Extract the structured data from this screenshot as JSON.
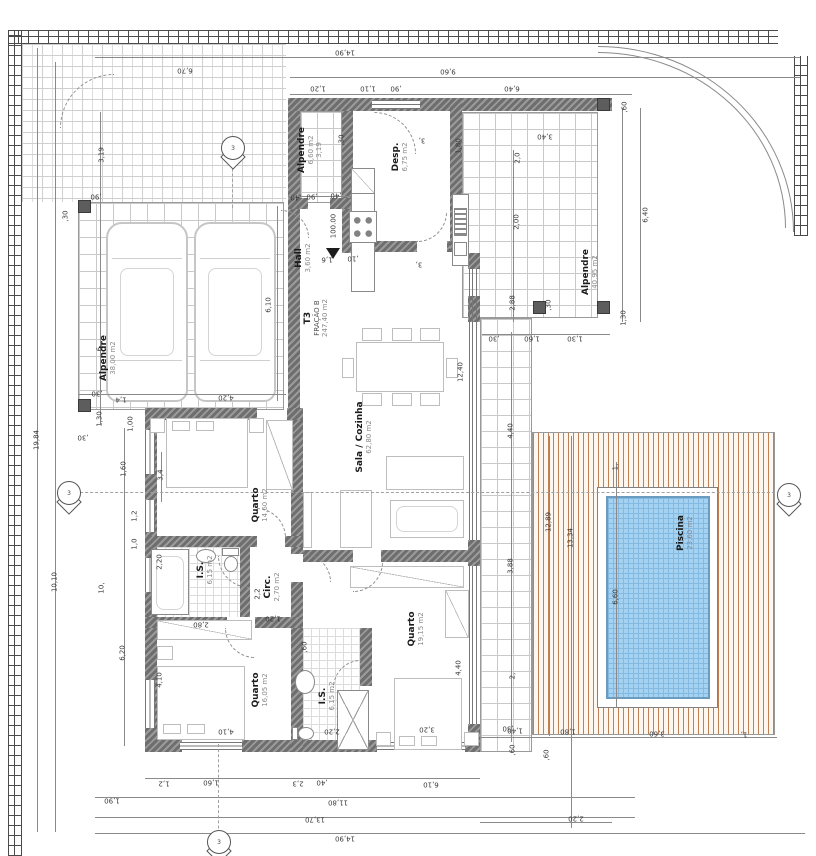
{
  "drawing": {
    "level_marker": "100.00",
    "section_marker_number": "3"
  },
  "rooms": [
    {
      "id": "garage",
      "name": "Alpendre",
      "area": "38,00 m2"
    },
    {
      "id": "porch",
      "name": "Alpendre",
      "area": "6,60 m2",
      "note": "3,19"
    },
    {
      "id": "desp",
      "name": "Desp.",
      "area": "6,75 m2"
    },
    {
      "id": "hall",
      "name": "Hall",
      "area": "3,60 m2"
    },
    {
      "id": "fracao",
      "name": "T3",
      "sub": "FRAÇÃO B",
      "area": "247,40 m2"
    },
    {
      "id": "sala",
      "name": "Sala / Cozinha",
      "area": "62,80 m2"
    },
    {
      "id": "q1",
      "name": "Quarto",
      "area": "14,60 m2"
    },
    {
      "id": "is1",
      "name": "I.S.",
      "area": "6,15 m2"
    },
    {
      "id": "circ",
      "name": "Circ.",
      "area": "2,70 m2"
    },
    {
      "id": "q2",
      "name": "Quarto",
      "area": "16,05 m2"
    },
    {
      "id": "is2",
      "name": "I.S.",
      "area": "6,15 m2"
    },
    {
      "id": "q3",
      "name": "Quarto",
      "area": "19,15 m2"
    },
    {
      "id": "terrace",
      "name": "Alpendre",
      "area": "40,95 m2"
    },
    {
      "id": "piscina",
      "name": "Piscina",
      "area": "23,60 m2"
    }
  ],
  "dim_labels": [
    "14,90",
    "9,60",
    "1,20",
    "1,10",
    ",90",
    "6,40",
    "6,70",
    ",90",
    "3,19",
    ",30",
    "6,",
    "1,30",
    "19,84",
    "10,10",
    "6,10",
    "4,20",
    "1,4",
    ",30",
    "1,00",
    ",30",
    "1,60",
    "3,4",
    "1,2",
    "1,0",
    "10,",
    "6,20",
    "2,20",
    "4,10",
    "2,80",
    "1,20",
    ",60",
    "2,2",
    "4,10",
    "2,20",
    "3,20",
    ",30",
    "1,2",
    "1,60",
    "2,3",
    ",40",
    "6,10",
    "1,90",
    "11,80",
    "13,70",
    "14,90",
    "1,40",
    "1,80",
    "3,60",
    "1,",
    ",60",
    ",60",
    "2,20",
    "12,89",
    "13,34",
    "1,",
    "6,60",
    "3,40",
    "2,0",
    "2,00",
    "2,88",
    ",30",
    ",60",
    "6,40",
    "1,30",
    ",30",
    "1,60",
    "1,30",
    "3,88",
    "2,",
    "4,40",
    "4,40",
    "12,40",
    "3,",
    "3,",
    "1,6",
    ",10",
    ",40",
    ",90",
    ",40",
    ",30",
    "1,80"
  ],
  "colors": {
    "wall": "#6e6e6e",
    "pool_water": "#a6d2f2",
    "pool_grid": "#84b9e2",
    "deck_stripe": "#c08055",
    "tile_line": "#c9c9c9",
    "boundary": "#4a4a4a",
    "dim_text": "#3a3a3a"
  }
}
